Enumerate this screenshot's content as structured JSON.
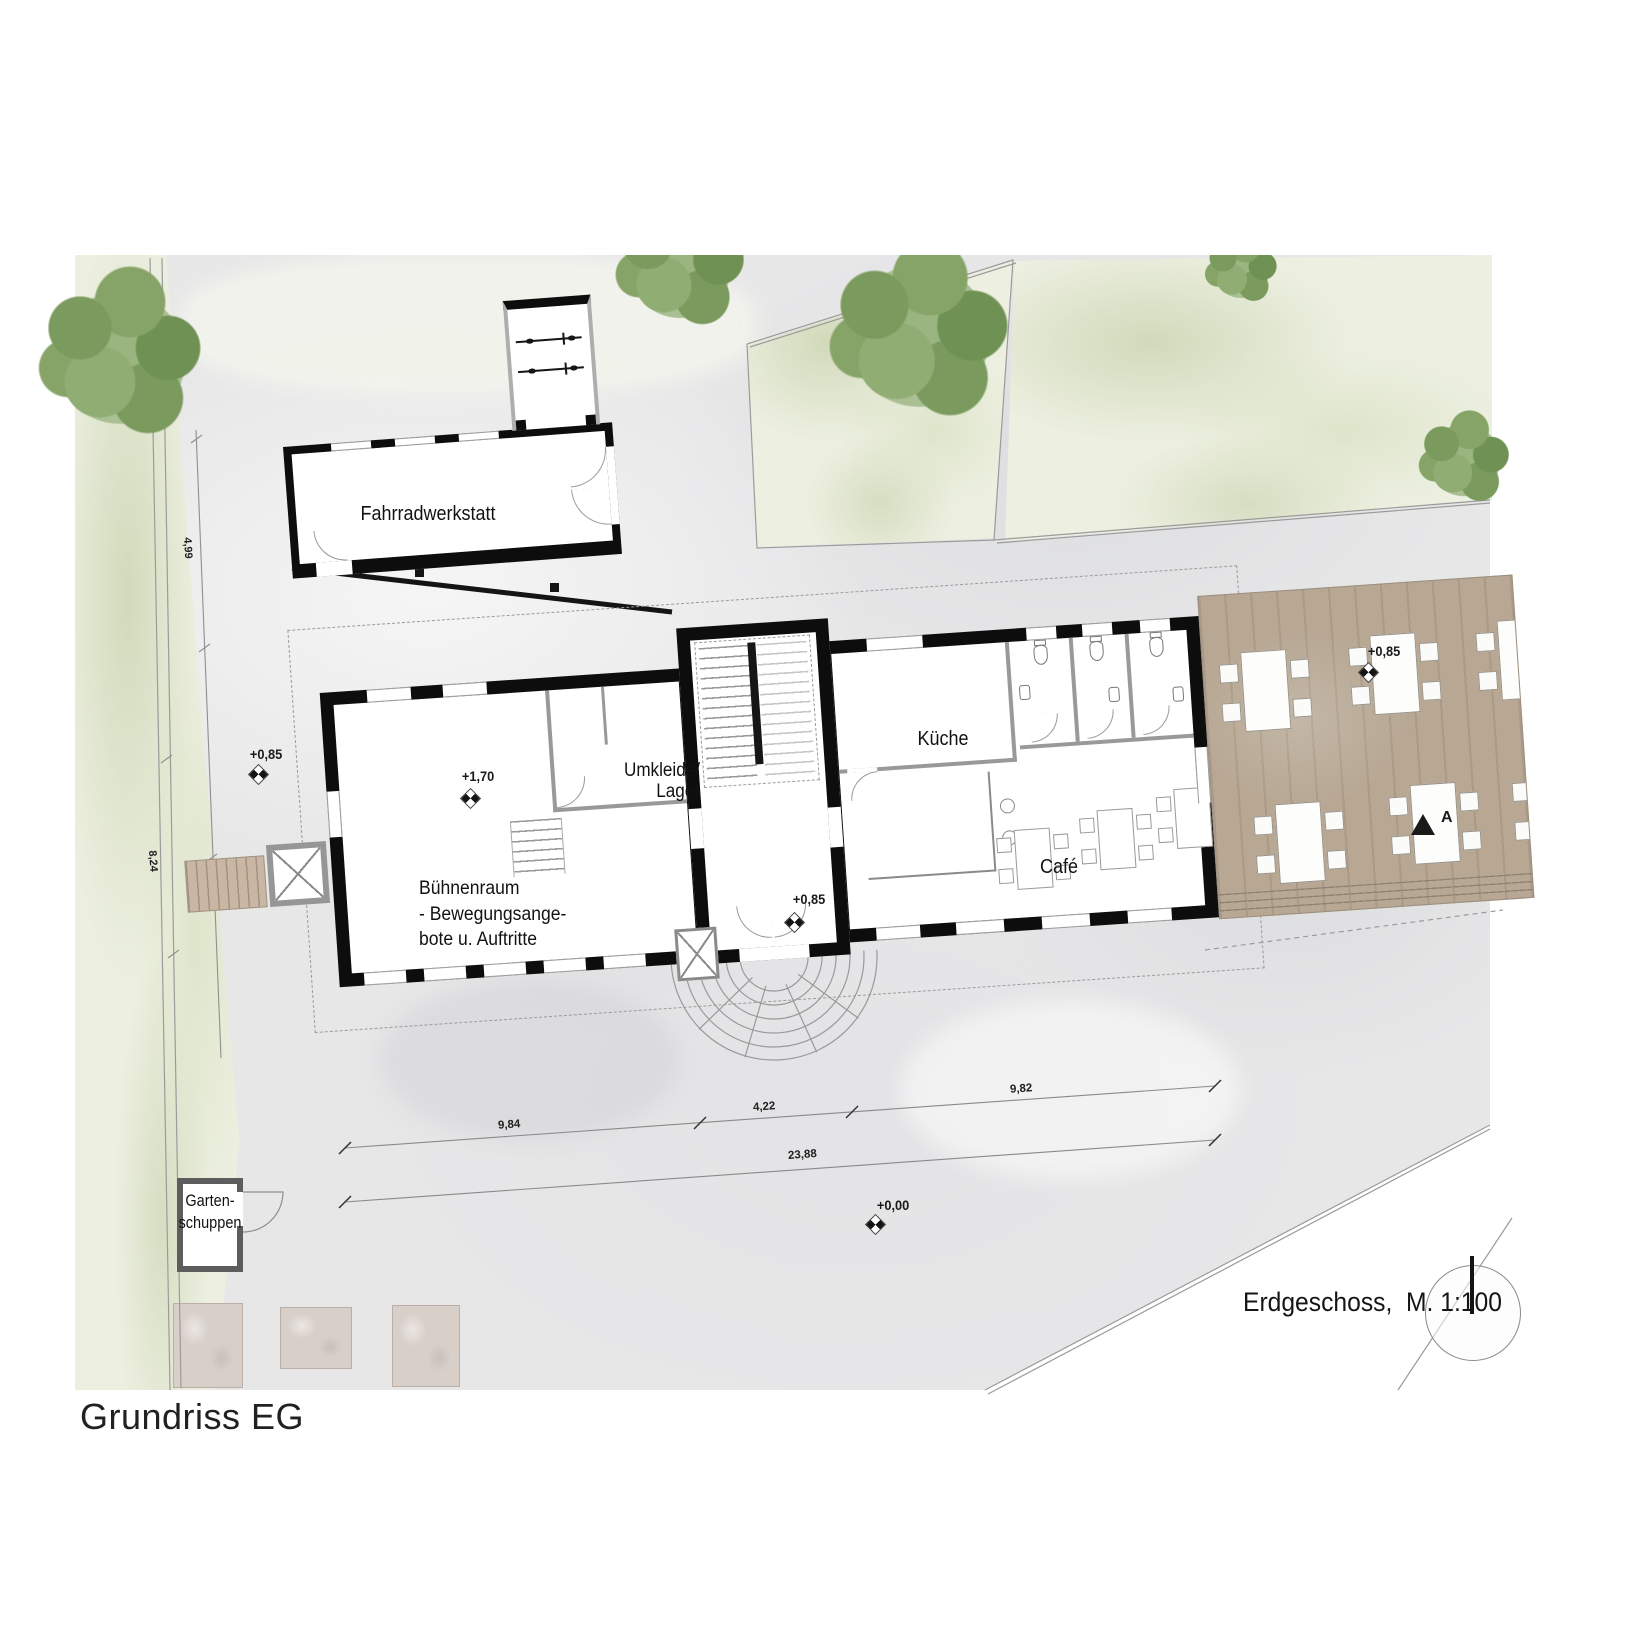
{
  "caption": "Grundriss EG",
  "plan": {
    "title": "Erdgeschoss,  M. 1:100",
    "rooms": {
      "fahrradwerkstatt": "Fahrradwerkstatt",
      "umkleide_line1": "Umkleide/",
      "umkleide_line2": "Lager",
      "kueche": "Küche",
      "cafe": "Café",
      "buehne_line1": "Bühnenraum",
      "buehne_line2": "- Bewegungsange-",
      "buehne_line3": "bote u. Auftritte",
      "gartenschuppen_line1": "Garten-",
      "gartenschuppen_line2": "schuppen"
    },
    "levels": {
      "site_left": "+0,85",
      "stage": "+1,70",
      "foyer": "+0,85",
      "terrace": "+0,85",
      "ground": "+0,00"
    },
    "dimensions": {
      "seg1": "9,84",
      "seg2": "4,22",
      "seg3": "9,82",
      "total": "23,88",
      "left_upper": "4,99",
      "left_lower": "8,24"
    },
    "section_marker": "A",
    "colors": {
      "wall": "#111111",
      "site": "#e7e7e8",
      "grass": "#edf0e1",
      "tree": "#7b9a5e",
      "deck": "#b7a793"
    }
  }
}
